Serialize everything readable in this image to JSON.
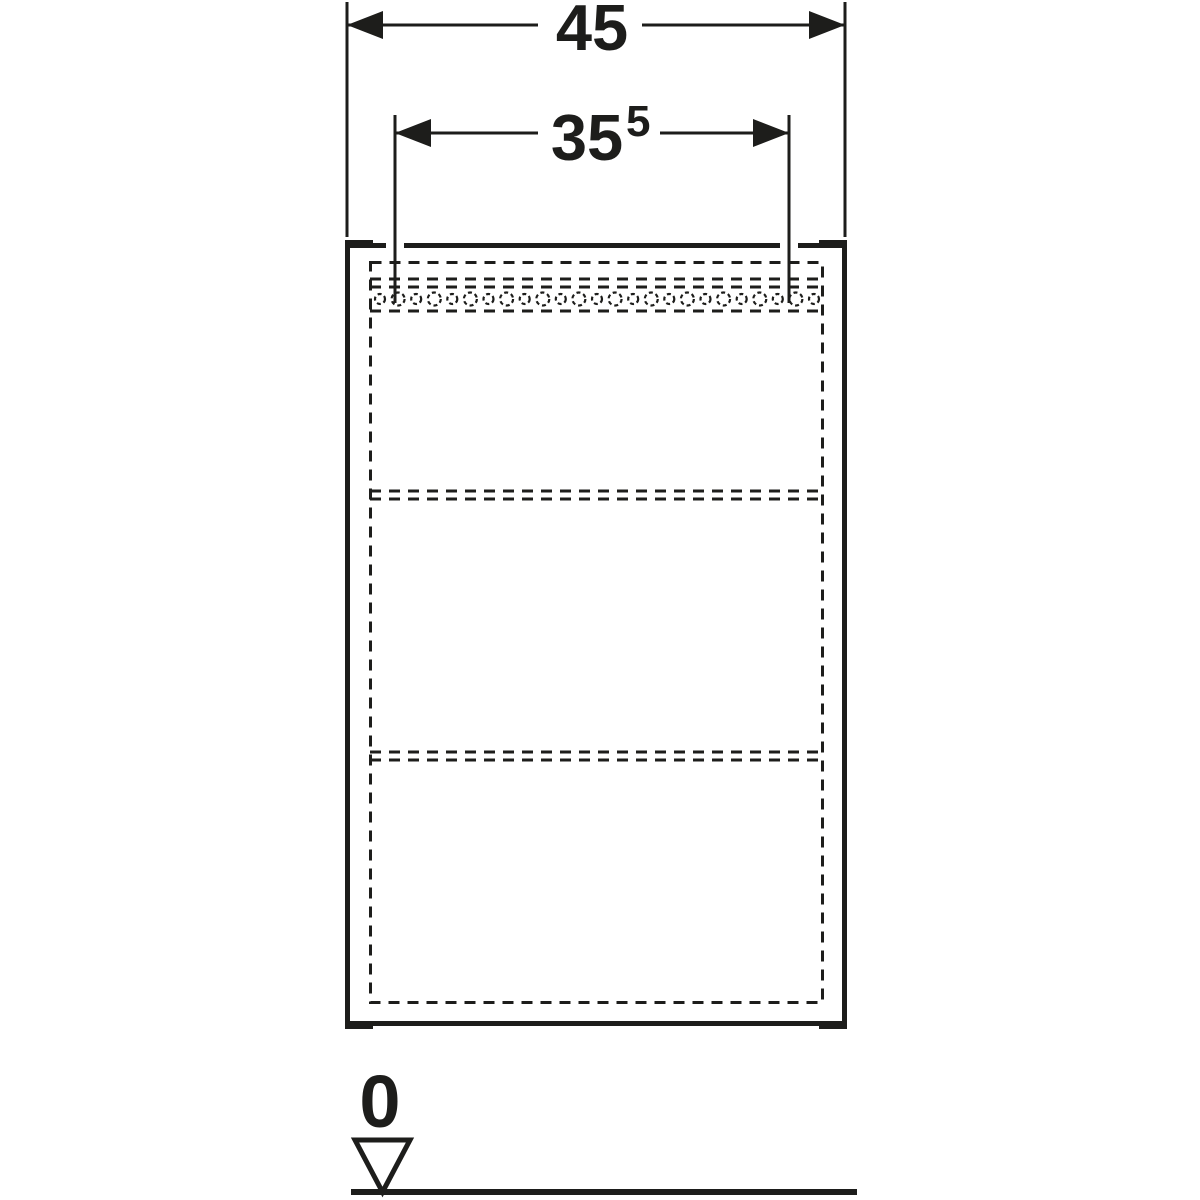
{
  "page": {
    "background_color": "#ffffff",
    "line_color": "#1d1d1b",
    "drawing_type": "cabinet-front-view-technical-drawing"
  },
  "dimensions": {
    "total_width": {
      "value": "45"
    },
    "inner_width": {
      "value": "35",
      "superscript": "5"
    }
  },
  "datum": {
    "label": "0"
  },
  "cabinet": {
    "shelf_lines": 2,
    "perforation_holes": 25
  }
}
